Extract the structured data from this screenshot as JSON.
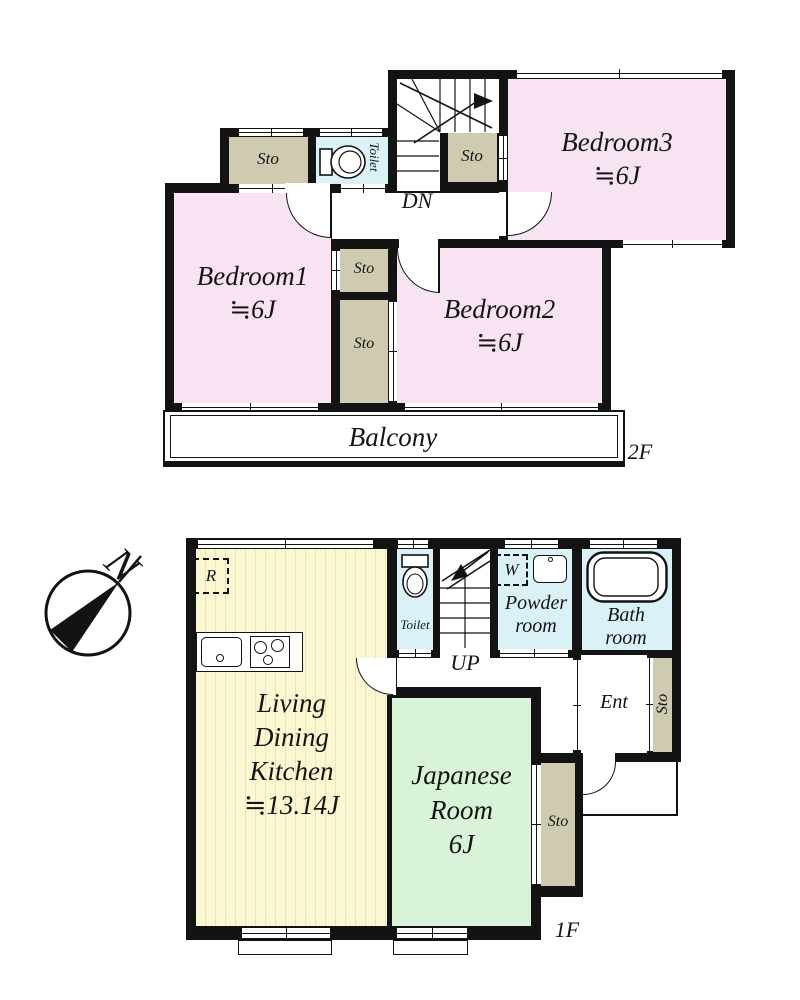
{
  "colors": {
    "wall": "#131313",
    "bedroom_pink": "#f8e3f3",
    "storage_beige": "#cfcbb1",
    "water_blue": "#d9f1f7",
    "tatami_green": "#d9f3d8",
    "ldk_yellow": "#fbf7d1",
    "ldk_stripe": "#e9e3bb",
    "white": "#ffffff"
  },
  "labels": {
    "floor2": "2F",
    "floor1": "1F",
    "bedroom1": {
      "name": "Bedroom1",
      "area": "≒6J"
    },
    "bedroom2": {
      "name": "Bedroom2",
      "area": "≒6J"
    },
    "bedroom3": {
      "name": "Bedroom3",
      "area": "≒6J"
    },
    "ldk": {
      "l1": "Living",
      "l2": "Dining",
      "l3": "Kitchen",
      "area": "≒13.14J"
    },
    "japanese": {
      "l1": "Japanese",
      "l2": "Room",
      "l3": "6J"
    },
    "balcony": "Balcony",
    "toilet": "Toilet",
    "powder": {
      "l1": "Powder",
      "l2": "room"
    },
    "bath": {
      "l1": "Bath",
      "l2": "room"
    },
    "ent": "Ent",
    "sto": "Sto",
    "dn": "DN",
    "up": "UP",
    "north": "N",
    "refrigerator": "R",
    "washer": "W"
  }
}
